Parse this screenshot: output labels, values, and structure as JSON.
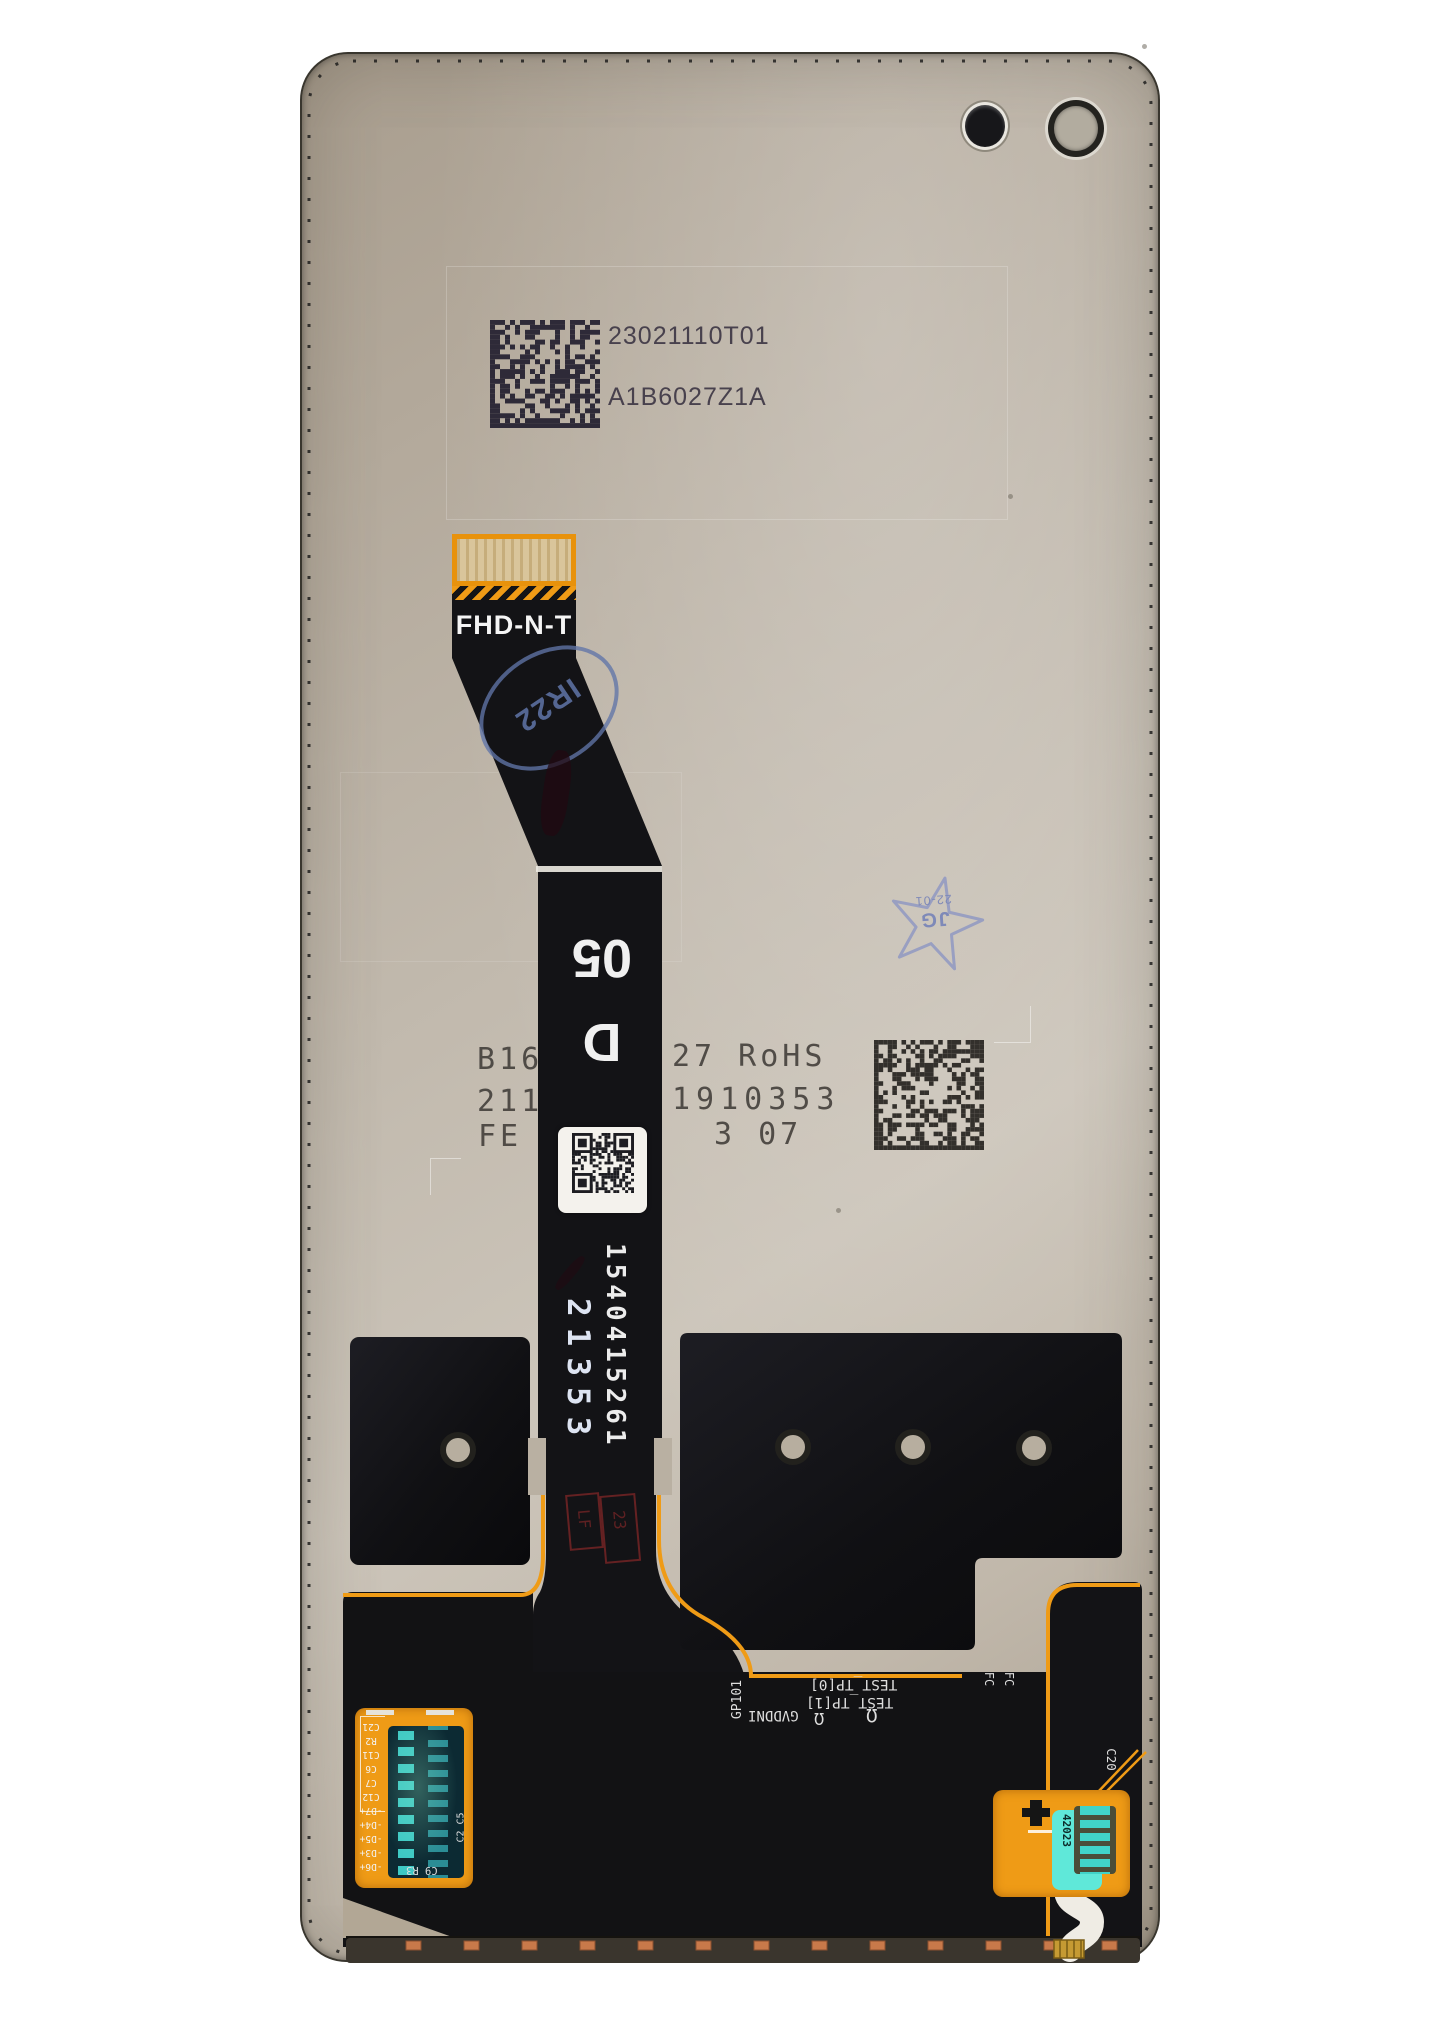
{
  "photo": {
    "subject": "smartphone LCD display assembly rear view with flex cables",
    "codes": {
      "datamatrix_top_label": "23021110T01",
      "model_code": "A1B6027Z1A",
      "flex_marking": "FHD-N-T",
      "oval_stamp": "IR22",
      "star_stamp_initials": "JG",
      "star_stamp_date": "22-01",
      "grade_letter": "D",
      "grade_number": "05",
      "print_row1_left": "B16",
      "print_row1_right": "27 RoHS",
      "print_row2_left": "211",
      "print_row2_right": "1910353",
      "print_row3_left": "FE",
      "print_row3_right": "3 07",
      "ribbon_serial": "1540415261",
      "ribbon_batch": "21353",
      "red_stamp_left": "LF",
      "red_stamp_right": "23"
    },
    "silkscreen": {
      "gpio": "GP101",
      "test_tp0": "TEST_TP[0]",
      "test_tp1": "TEST_TP[1]",
      "gvddni": "GVDDNI",
      "fc_left": "FC",
      "fc_right": "FC",
      "c20": "C20",
      "c2_c5": "C2 C5",
      "c9_r3": "C9 R3",
      "left_connector_labels": [
        "C21",
        "R2",
        "C11",
        "C6",
        "C7",
        "C12",
        "-D7+",
        "-D4+",
        "-D5+",
        "-D3+",
        "-D6+"
      ],
      "right_connector_code": "42023"
    },
    "icons": {
      "probe_loop": "Ω"
    },
    "colors": {
      "backplate_beige": "#bdb4a7",
      "flex_black": "#131316",
      "flex_orange": "#ef9b16",
      "stamp_blue": "#6b7aa8",
      "stamp_red": "#a83232",
      "copper_pad": "#c8794a",
      "connector_teal": "#3ec9c4",
      "connector_cyan": "#5fe8d9",
      "barcode_ink": "#2e2a38"
    }
  }
}
